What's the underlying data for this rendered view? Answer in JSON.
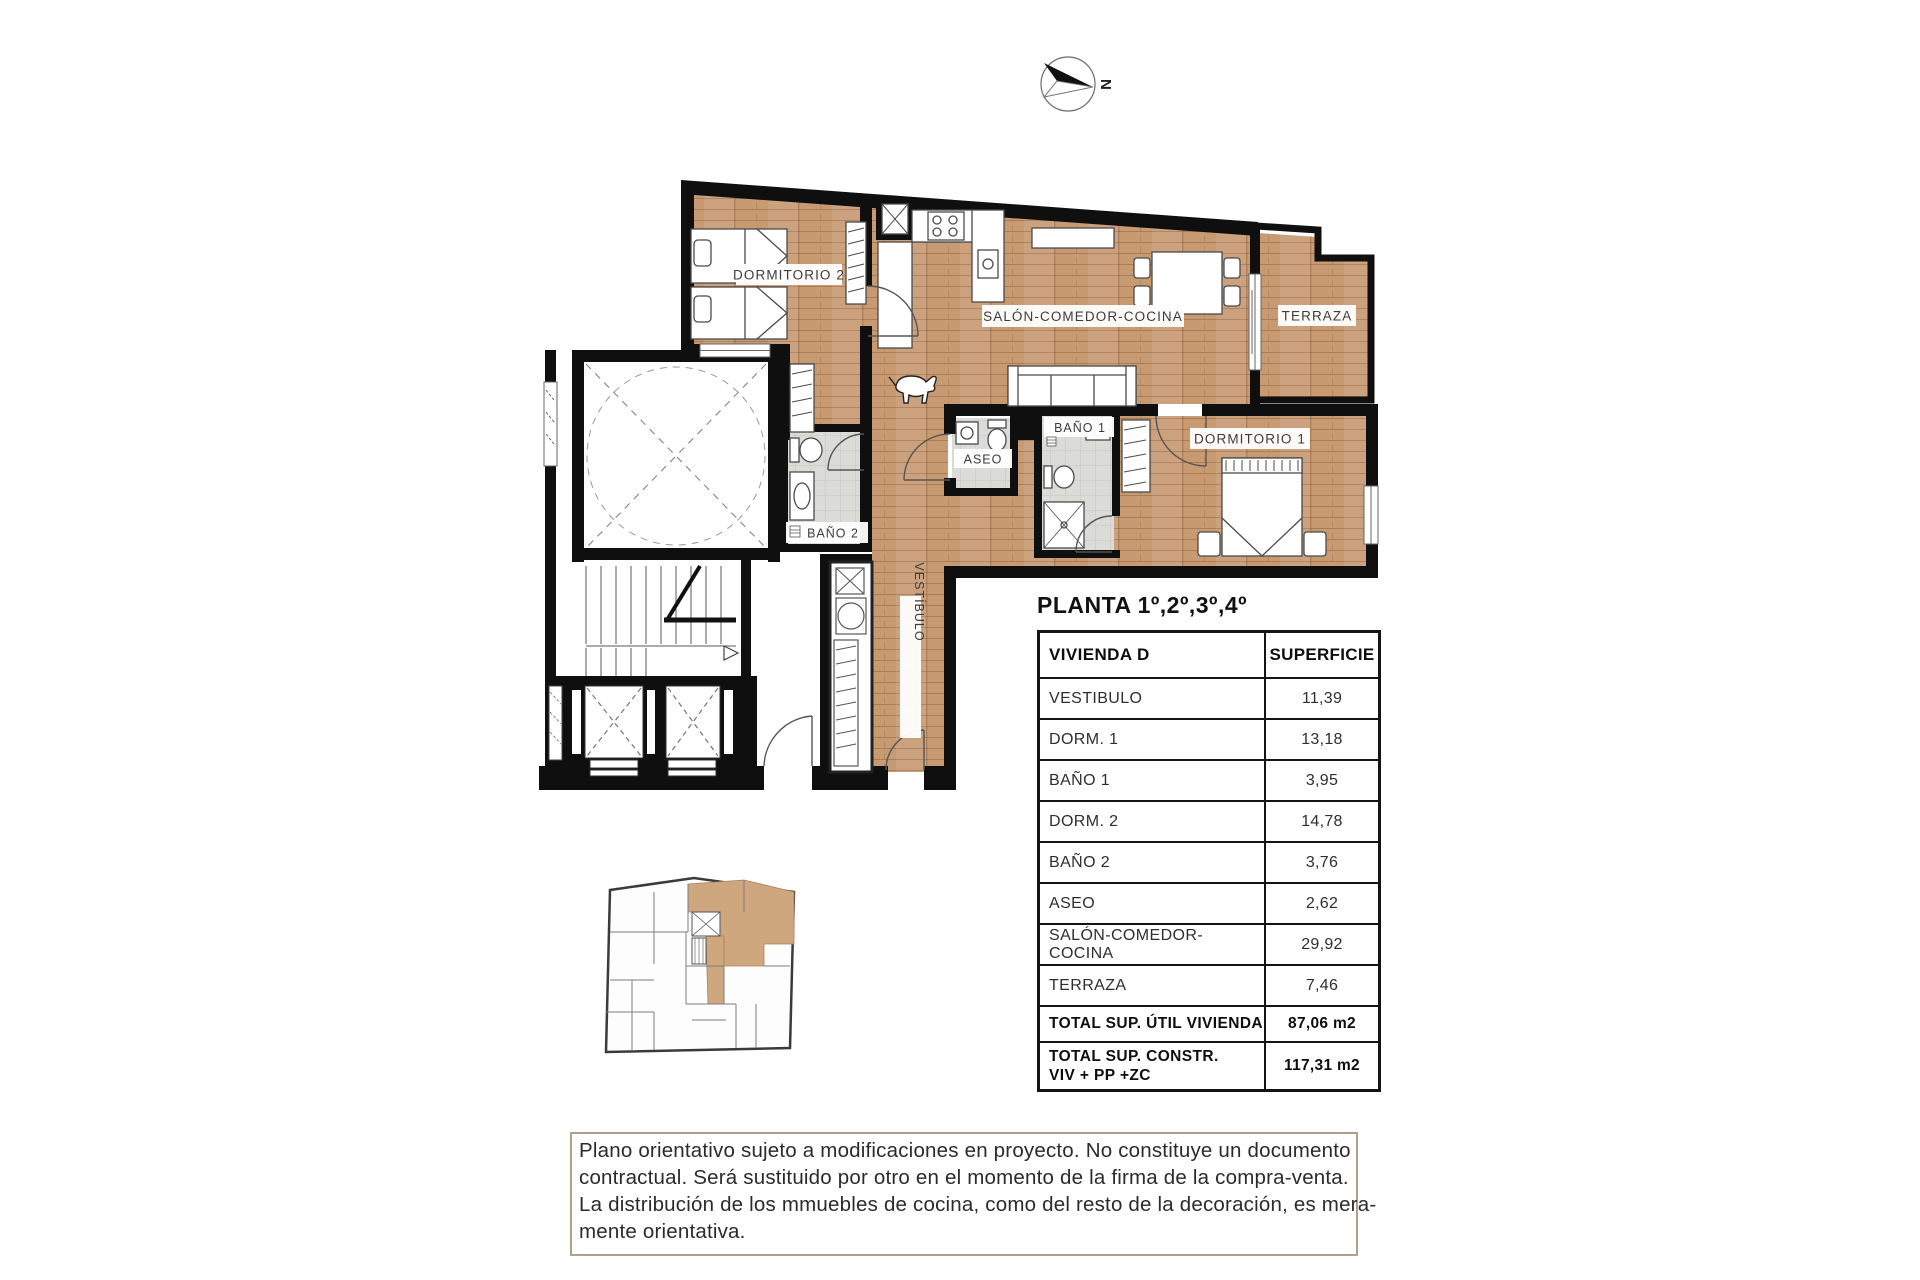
{
  "compass": {
    "north_label": "N"
  },
  "plan": {
    "room_labels": {
      "dormitorio2": "DORMITORIO 2",
      "salon": "SALÓN-COMEDOR-COCINA",
      "terraza": "TERRAZA",
      "dormitorio1": "DORMITORIO 1",
      "bano1": "BAÑO 1",
      "bano2": "BAÑO 2",
      "aseo": "ASEO",
      "vestibulo": "VESTÍBULO"
    }
  },
  "heading": {
    "title": "PLANTA 1º,2º,3º,4º"
  },
  "table": {
    "headers": {
      "name": "VIVIENDA D",
      "area": "SUPERFICIE"
    },
    "rows": [
      {
        "label": "VESTIBULO",
        "value": "11,39"
      },
      {
        "label": "DORM. 1",
        "value": "13,18"
      },
      {
        "label": "BAÑO 1",
        "value": "3,95"
      },
      {
        "label": "DORM. 2",
        "value": "14,78"
      },
      {
        "label": "BAÑO 2",
        "value": "3,76"
      },
      {
        "label": "ASEO",
        "value": "2,62"
      },
      {
        "label": "SALÓN-COMEDOR-COCINA",
        "value": "29,92"
      },
      {
        "label": "TERRAZA",
        "value": "7,46"
      }
    ],
    "totals": [
      {
        "label": "TOTAL SUP. ÚTIL VIVIENDA",
        "value": "87,06 m2"
      },
      {
        "label_line1": "TOTAL SUP. CONSTR.",
        "label_line2": "VIV + PP +ZC",
        "value": "117,31 m2"
      }
    ]
  },
  "disclaimer": {
    "lines": [
      "Plano orientativo sujeto a modificaciones en proyecto. No constituye un documento",
      "contractual. Será sustituido por otro en el momento de la firma de la compra-venta.",
      "La distribución de los mmuebles de cocina, como del resto de la decoración, es mera-",
      "mente orientativa."
    ]
  },
  "colors": {
    "wood": "#c79a72",
    "tile": "#dbdbd7",
    "wall": "#0f0f0f",
    "highlight_unit": "#cfa77f",
    "disclaimer_border": "#b1a087"
  }
}
